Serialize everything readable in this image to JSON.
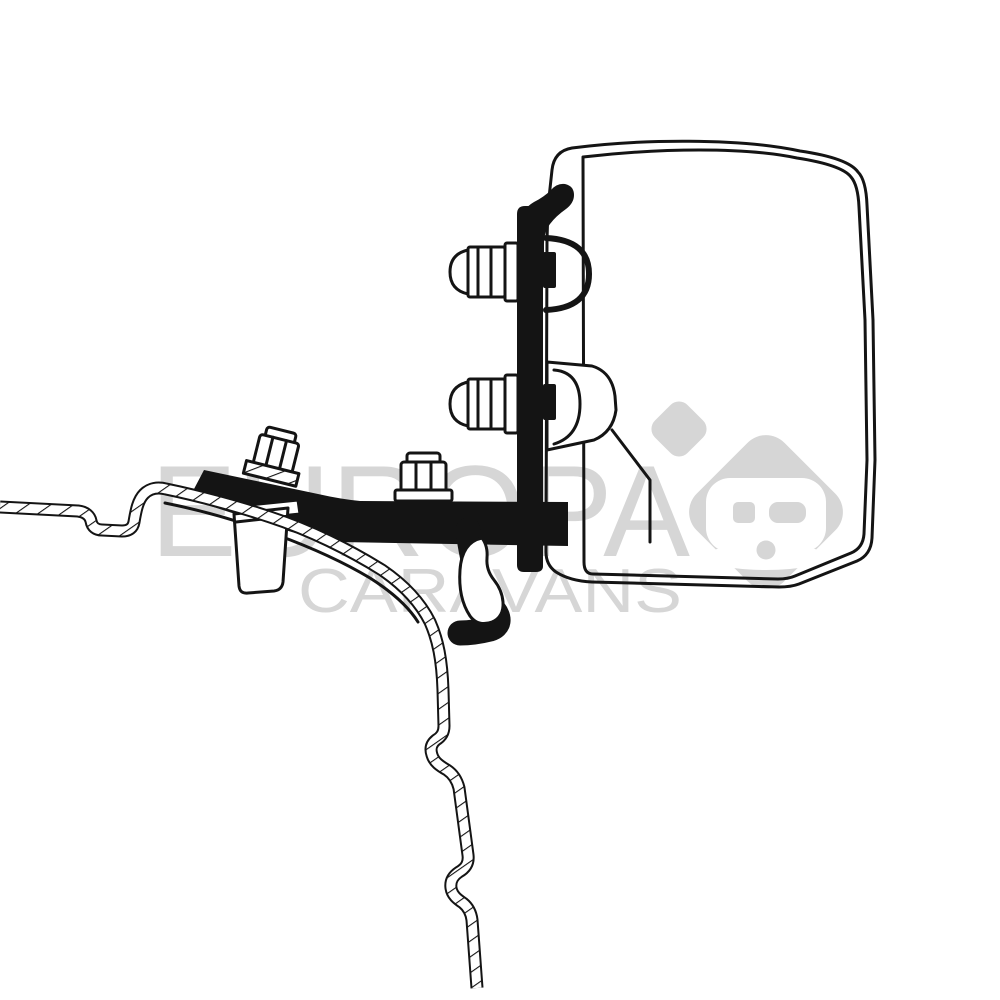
{
  "page": {
    "background_color": "#ffffff"
  },
  "watermark": {
    "line1": "EUROPA",
    "line2": "CARAVANS",
    "color": "#d6d6d6",
    "logo_icon": "caravan-in-rounded-diamond"
  },
  "artwork": {
    "subject": "Cross-section technical line drawing of an awning adapter bracket mounted on a van roof rail",
    "line_color": "#141414",
    "solid_fill_color": "#141414",
    "paper_color": "#ffffff"
  }
}
